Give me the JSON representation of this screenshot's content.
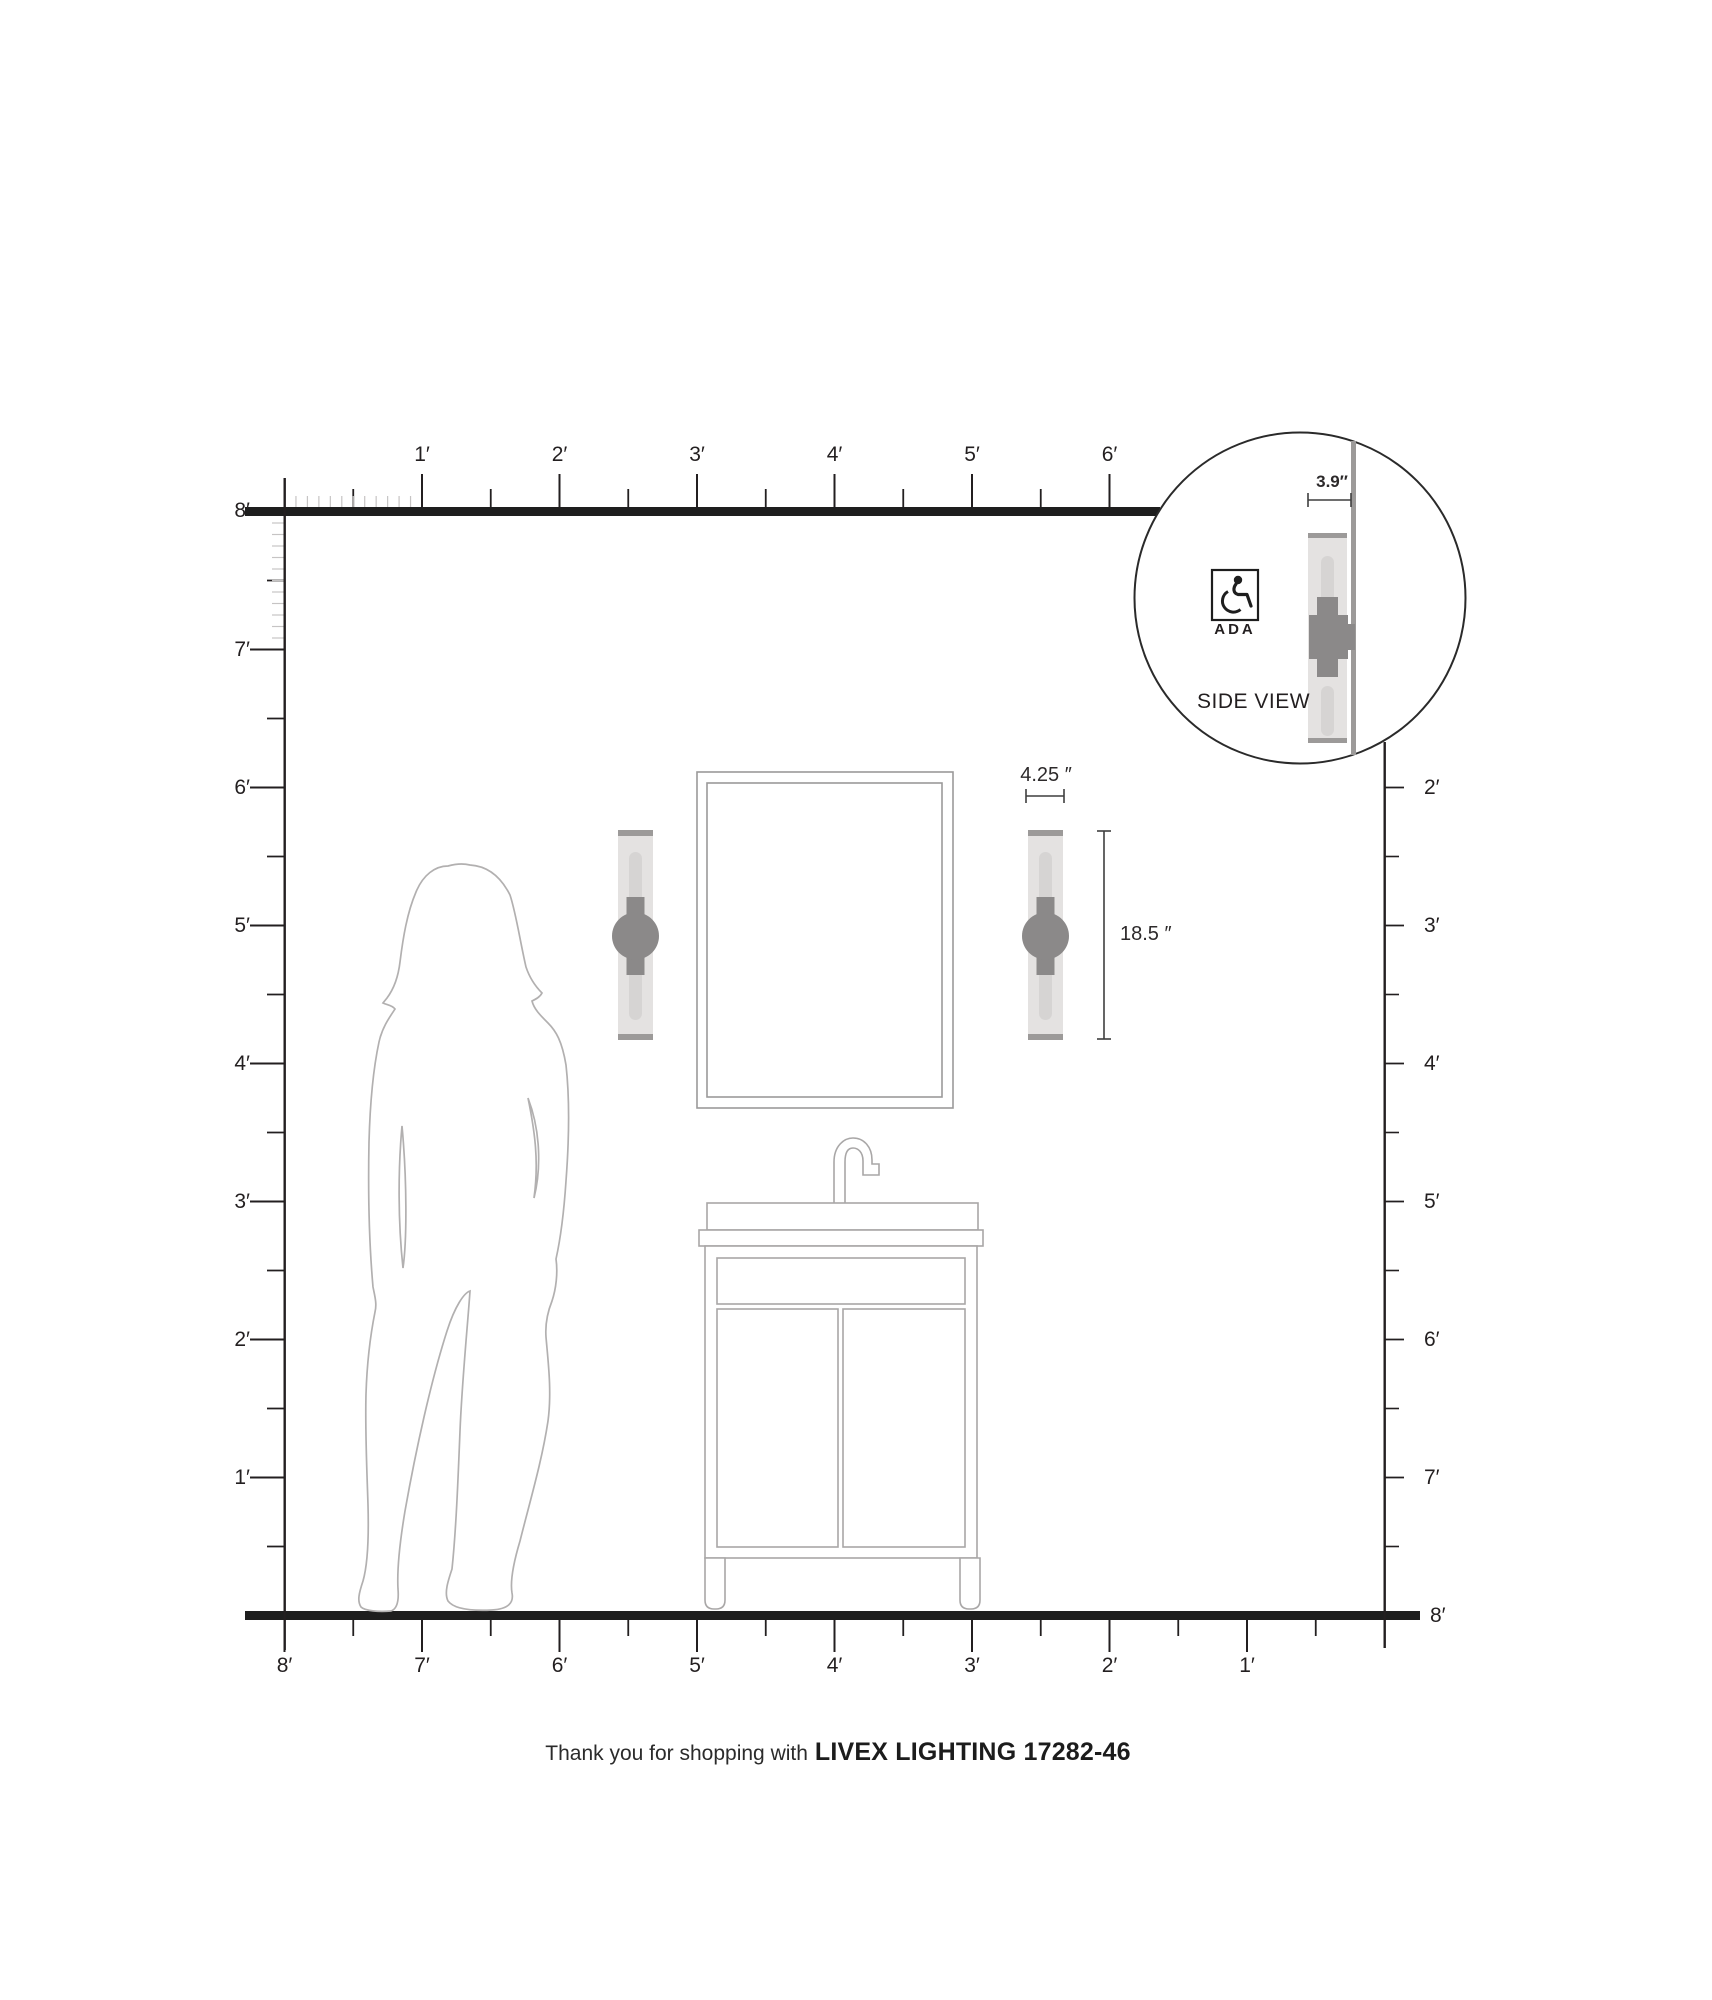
{
  "footer": {
    "prefix": "Thank you for shopping with",
    "brand": "LIVEX LIGHTING 17282-46"
  },
  "inset": {
    "side_view_label": "SIDE VIEW",
    "ada_label": "ADA",
    "depth_label": "3.9″"
  },
  "dimensions": {
    "width_label": "4.25 ″",
    "height_label": "18.5 ″"
  },
  "rulers": {
    "top": {
      "labels": [
        "1′",
        "2′",
        "3′",
        "4′",
        "5′",
        "6′"
      ]
    },
    "left": {
      "origin_label": "8′",
      "labels": [
        "7′",
        "6′",
        "5′",
        "4′",
        "3′",
        "2′",
        "1′"
      ]
    },
    "right": {
      "labels": [
        "2′",
        "3′",
        "4′",
        "5′",
        "6′",
        "7′"
      ],
      "floor_label": "8′"
    },
    "bottom": {
      "labels": [
        "8′",
        "7′",
        "6′",
        "5′",
        "4′",
        "3′",
        "2′",
        "1′"
      ]
    }
  },
  "colors": {
    "ink": "#231f20",
    "wall_line": "#1e1e1e",
    "outline_gray": "#a9a7a7",
    "sconce_body": "#e4e2e1",
    "sconce_glass": "#d6d4d3",
    "sconce_cap": "#9c9a99",
    "sconce_mount": "#8b8989",
    "inset_wall": "#9c9a99",
    "dimension_line": "#3f3f3f"
  }
}
